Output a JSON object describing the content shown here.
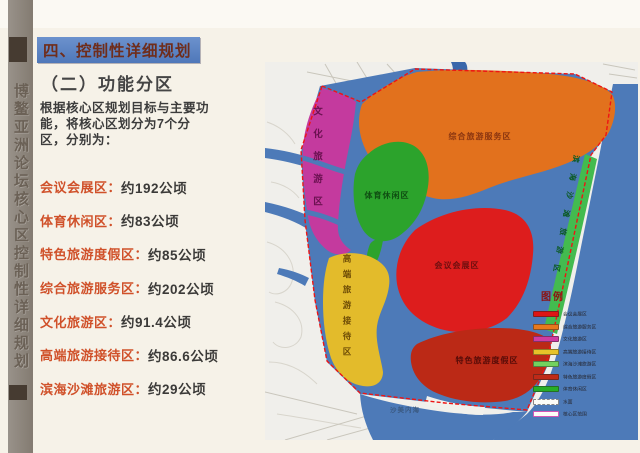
{
  "slide": {
    "side_title": "博鳌亚洲论坛核心区控制性详细规划",
    "title": "四、控制性详细规划",
    "subtitle": "（二）功能分区",
    "intro": "根据核心区规划目标与主要功能，将核心区划分为7个分区，分别为：",
    "zones": [
      {
        "label": "会议会展区：",
        "value": "约192公顷"
      },
      {
        "label": "体育休闲区：",
        "value": "约83公顷"
      },
      {
        "label": "特色旅游度假区：",
        "value": "约85公顷"
      },
      {
        "label": "综合旅游服务区：",
        "value": "约202公顷"
      },
      {
        "label": "文化旅游区：",
        "value": "约91.4公顷"
      },
      {
        "label": "高端旅游接待区：",
        "value": "约86.6公顷"
      },
      {
        "label": "滨海沙滩旅游区：",
        "value": "约29公顷"
      }
    ]
  },
  "map": {
    "zone_labels": {
      "comprehensive": "综合旅游服务区",
      "sports": "体育休闲区",
      "conference": "会议会展区",
      "featured": "特色旅游度假区",
      "cultural": "文化旅游区",
      "highend": "高端旅游接待区",
      "beach": "滨海沙滩旅游区"
    },
    "water_label": "沙美内海",
    "legend": {
      "title": "图例",
      "items": [
        {
          "label": "会议会展区",
          "color": "#dd1515",
          "swatch": "fill"
        },
        {
          "label": "综合旅游服务区",
          "color": "#e8791c",
          "swatch": "fill"
        },
        {
          "label": "文化旅游区",
          "color": "#cf3ba2",
          "swatch": "fill"
        },
        {
          "label": "高端旅游接待区",
          "color": "#e7c329",
          "swatch": "fill"
        },
        {
          "label": "滨海沙滩旅游区",
          "color": "#72d25e",
          "swatch": "fill"
        },
        {
          "label": "特色旅游度假区",
          "color": "#bf2a18",
          "swatch": "fill"
        },
        {
          "label": "体育休闲区",
          "color": "#27ae27",
          "swatch": "fill"
        },
        {
          "label": "水面",
          "color": "#ffffff",
          "swatch": "dashed"
        },
        {
          "label": "核心区范围",
          "color": "#e060c0",
          "swatch": "outline"
        }
      ]
    },
    "zone_fills": {
      "cultural": "#c43a9e",
      "comprehensive": "#e2711d",
      "sports": "#2ca32c",
      "conference": "#dd1d1d",
      "highend": "#e3bb2b",
      "featured": "#bb2916",
      "beach_strip": "#43bb4f",
      "water": "#4d7ab8",
      "boundary": "#ee1414"
    }
  },
  "colors": {
    "title_bg": "#5b83c2",
    "title_text": "#6f2d1b",
    "list_label": "#d0512a",
    "sidebar": "#8c8279"
  }
}
